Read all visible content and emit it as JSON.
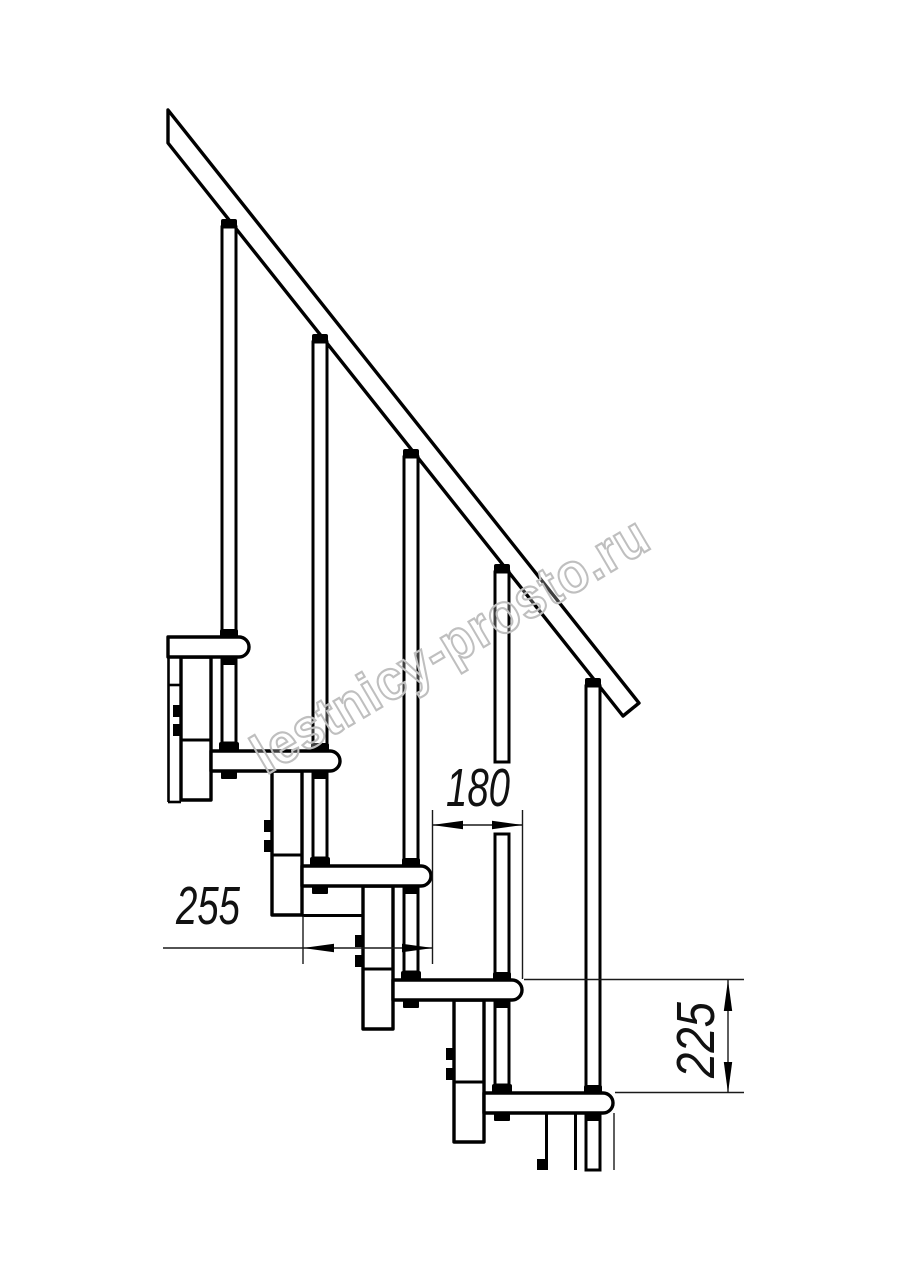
{
  "watermark": {
    "text": "lestnicy-prosto.ru"
  },
  "dimensions": {
    "tread_depth": {
      "label": "255"
    },
    "tread_offset": {
      "label": "180"
    },
    "riser_height": {
      "label": "225"
    }
  }
}
